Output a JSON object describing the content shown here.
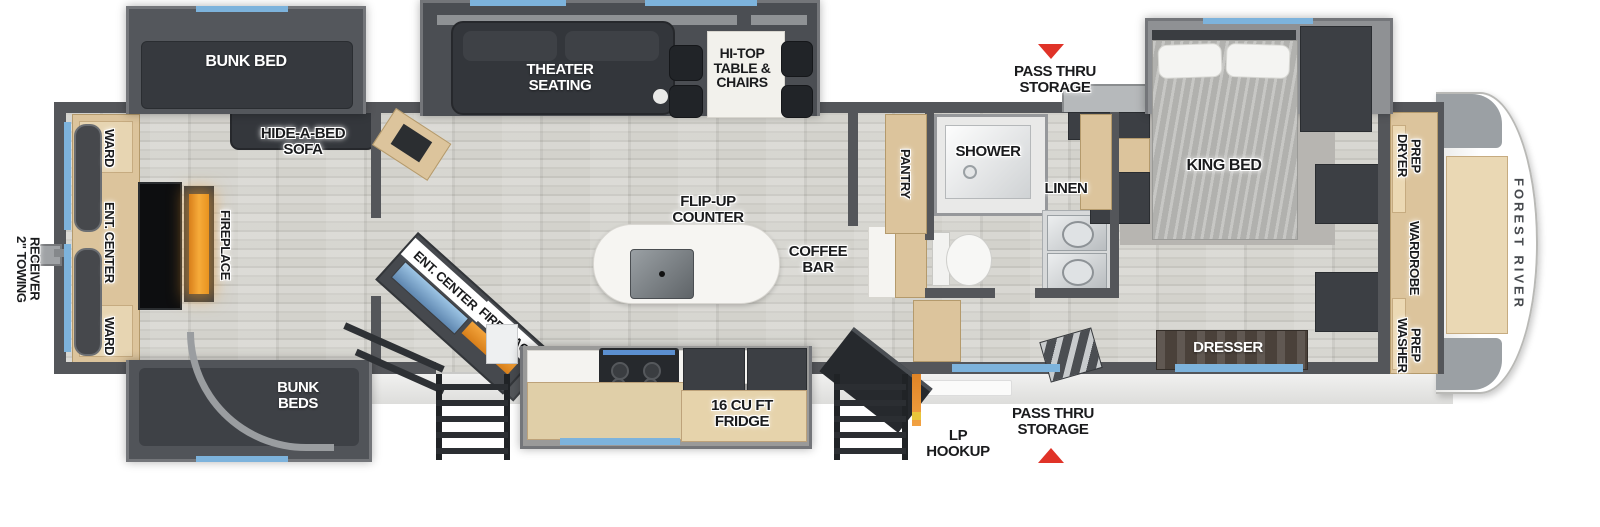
{
  "title": "Fifth Wheel RV Floor Plan",
  "brand": "FOREST RIVER",
  "colors": {
    "wall_gray": "#54565a",
    "cabinet_tan": "#dcc49c",
    "window_blue": "#7db3dc",
    "fireplace_orange": "#f2a243",
    "arrow_red": "#e03328",
    "dark_furniture": "#3c3f44"
  },
  "labels": {
    "bunk_bed": "BUNK BED",
    "theater_seating": "THEATER SEATING",
    "hi_top_table": "HI-TOP TABLE & CHAIRS",
    "hide_a_bed_sofa": "HIDE-A-BED SOFA",
    "pass_thru_storage_top": "PASS THRU STORAGE",
    "king_bed": "KING BED",
    "ward_top": "WARD",
    "ent_center_rear": "ENT. CENTER",
    "ward_bottom": "WARD",
    "fireplace_rear": "FIREPLACE",
    "towing_receiver": "2\" TOWING RECEIVER",
    "bunk_beds": "BUNK BEDS",
    "ent_center_mid": "ENT. CENTER",
    "fireplace_mid": "FIREPLACE",
    "flip_up_counter": "FLIP-UP COUNTER",
    "coffee_bar": "COFFEE BAR",
    "fridge": "16 CU FT FRIDGE",
    "pantry": "PANTRY",
    "shower": "SHOWER",
    "linen": "LINEN",
    "lp_hookup": "LP HOOKUP",
    "pass_thru_storage_bottom": "PASS THRU STORAGE",
    "dresser": "DRESSER",
    "dryer_prep": "DRYER PREP",
    "wardrobe": "WARDROBE",
    "washer_prep": "WASHER PREP"
  }
}
